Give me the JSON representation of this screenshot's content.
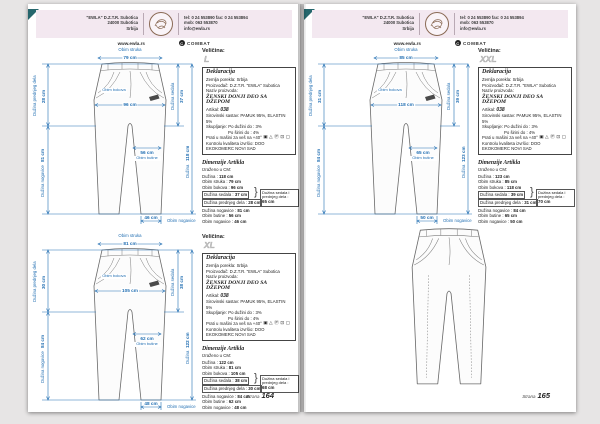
{
  "header": {
    "company_lines": [
      "\"EWLA\" D.Z.T.R.  Subotica",
      "24000 Subotica",
      "Srbija"
    ],
    "contact_lines": [
      "tel: 0 24 553890   fax: 0 24 553894",
      "mob: 063 553870",
      "info@ewla.rs"
    ],
    "website": "www.ewla.rs",
    "brand": "COMBAT",
    "brand_icon_glyph": "C"
  },
  "footer": {
    "label": "Strana",
    "page_numbers": [
      "164",
      "165"
    ]
  },
  "size_label": "Veličina:",
  "declaration": {
    "title": "Deklaracija",
    "country": "Zemlja porekla: Srbija",
    "manufacturer": "Proizvođač: D.Z.T.R. \"EWLA\" Subotica",
    "product_kind_label": "Naziv proizvoda:",
    "product_name": "ŽENSKI DONJI DEO SA DŽEPOM",
    "article_label": "Artikal:",
    "article_value": "038",
    "composition": "Sirovinski sastav: PAMUK 95%, ELASTIN 5%",
    "shrink_length": "Skupljanje: Po dužini do : 3%",
    "shrink_width": "Po širini do : 4%",
    "care_text": "Prati u mašini za veš na +40°",
    "care_icons": [
      {
        "name": "wash-40-icon",
        "glyph": "▣"
      },
      {
        "name": "no-bleach-icon",
        "glyph": "△"
      },
      {
        "name": "dry-clean-p-icon",
        "glyph": "Ⓟ"
      },
      {
        "name": "iron-icon",
        "glyph": "⊡"
      },
      {
        "name": "tumble-dry-icon",
        "glyph": "▢"
      }
    ],
    "quality": "Kontrolu kvaliteta izvršio: DOO EKOKOMERC NOVI SAD"
  },
  "dimensions_title": "Dimenzije Artikla",
  "dimensions_sub": "Izraženo u CM:",
  "diagram_labels": {
    "waist": "Obim struka",
    "hips": "Obim bokova",
    "front": "Dužina prednjeg dela",
    "seat": "Dužina sedala",
    "thigh": "Obim butine",
    "leg": "Dužina nogavice",
    "total": "Dužina",
    "opening": "Obim nogavice"
  },
  "sections": [
    {
      "size": "L",
      "diagram": {
        "waist": "79 cm",
        "hips": "96 cm",
        "front": "28 cm",
        "seat": "37 cm",
        "thigh": "56 cm",
        "leg": "81 cm",
        "total": "118 cm",
        "opening": "46 cm"
      },
      "rows": [
        {
          "label": "Dužina :",
          "value": "118 cm"
        },
        {
          "label": "Obim struka :",
          "value": "79 cm"
        },
        {
          "label": "Obim bokova :",
          "value": "96 cm"
        },
        {
          "label": "Dužina sedala :",
          "value": "37 cm"
        },
        {
          "label": "Dužina prednjeg dela :",
          "value": "28 cm"
        },
        {
          "label": "Dužina nogavice :",
          "value": "81 cm"
        },
        {
          "label": "Obim butine :",
          "value": "56 cm"
        },
        {
          "label": "Obim nogavice :",
          "value": "46 cm"
        }
      ],
      "note_label": "Dužina sedala i prednjeg dela :",
      "note_value": "65 cm"
    },
    {
      "size": "XL",
      "diagram": {
        "waist": "81 cm",
        "hips": "105 cm",
        "front": "30 cm",
        "seat": "38 cm",
        "thigh": "62 cm",
        "leg": "84 cm",
        "total": "122 cm",
        "opening": "48 cm"
      },
      "rows": [
        {
          "label": "Dužina :",
          "value": "122 cm"
        },
        {
          "label": "Obim struka :",
          "value": "81 cm"
        },
        {
          "label": "Obim bokova :",
          "value": "105 cm"
        },
        {
          "label": "Dužina sedala :",
          "value": "38 cm"
        },
        {
          "label": "Dužina prednjeg dela :",
          "value": "30 cm"
        },
        {
          "label": "Dužina nogavice :",
          "value": "84 cm"
        },
        {
          "label": "Obim butine :",
          "value": "62 cm"
        },
        {
          "label": "Obim nogavice :",
          "value": "48 cm"
        }
      ],
      "note_label": "Dužina sedala i prednjeg dela :",
      "note_value": "68 cm"
    },
    {
      "size": "XXL",
      "diagram": {
        "waist": "85 cm",
        "hips": "118 cm",
        "front": "31 cm",
        "seat": "39 cm",
        "thigh": "65 cm",
        "leg": "84 cm",
        "total": "123 cm",
        "opening": "50 cm"
      },
      "rows": [
        {
          "label": "Dužina :",
          "value": "123 cm"
        },
        {
          "label": "Obim struka :",
          "value": "85 cm"
        },
        {
          "label": "Obim bokova :",
          "value": "118 cm"
        },
        {
          "label": "Dužina sedala :",
          "value": "39 cm"
        },
        {
          "label": "Dužina prednjeg dela :",
          "value": "31 cm"
        },
        {
          "label": "Dužina nogavice :",
          "value": "84 cm"
        },
        {
          "label": "Obim butine :",
          "value": "65 cm"
        },
        {
          "label": "Obim nogavice :",
          "value": "50 cm"
        }
      ],
      "note_label": "Dužina sedala i prednjeg dela :",
      "note_value": "70 cm"
    }
  ]
}
